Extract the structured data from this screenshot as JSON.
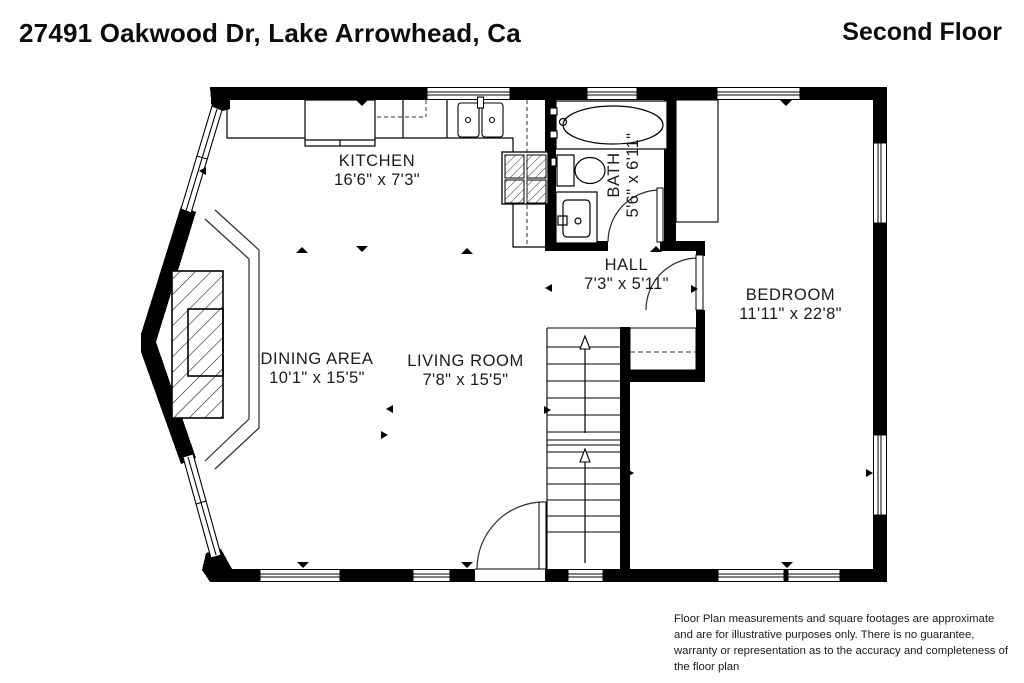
{
  "header": {
    "address": "27491 Oakwood Dr, Lake Arrowhead, Ca",
    "floor": "Second Floor"
  },
  "rooms": {
    "kitchen": {
      "name": "KITCHEN",
      "dims": "16'6\" x 7'3\""
    },
    "bath": {
      "name": "BATH",
      "dims": "5'6\" x 6'11\""
    },
    "hall": {
      "name": "HALL",
      "dims": "7'3\" x 5'11\""
    },
    "bedroom": {
      "name": "BEDROOM",
      "dims": "11'11\" x 22'8\""
    },
    "dining": {
      "name": "DINING AREA",
      "dims": "10'1\" x 15'5\""
    },
    "living": {
      "name": "LIVING ROOM",
      "dims": "7'8\" x 15'5\""
    }
  },
  "disclaimer": "Floor Plan measurements and square footages are approximate and are for illustrative purposes only. There is no guarantee, warranty or representation as to the accuracy and completeness of the floor plan",
  "colors": {
    "wall": "#000000",
    "line": "#2b2b2b",
    "background": "#ffffff"
  }
}
